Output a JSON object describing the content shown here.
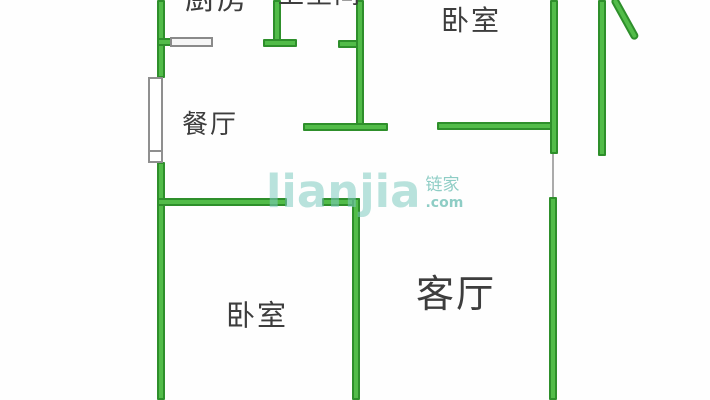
{
  "watermark": {
    "logo": "lianjia",
    "cjk": "链家",
    "tld": ".com"
  },
  "floorplan": {
    "colors": {
      "background": "#fefefe",
      "wall_fill": "#52bc49",
      "wall_edge": "#2e8f2b",
      "label_text": "#3d3d3d",
      "watermark_teal": "#7ecac0",
      "opening_gray": "#8f8f8f"
    },
    "rooms": [
      {
        "name": "room-label-kitchen",
        "label": "厨房",
        "cx": 217,
        "cy": 0,
        "font": 30
      },
      {
        "name": "room-label-bathroom",
        "label": "卫生间",
        "cx": 320,
        "cy": -5,
        "font": 26
      },
      {
        "name": "room-label-bedroom-top",
        "label": "卧室",
        "cx": 471,
        "cy": 21,
        "font": 28
      },
      {
        "name": "room-label-dining",
        "label": "餐厅",
        "cx": 210,
        "cy": 125,
        "font": 26
      },
      {
        "name": "room-label-bedroom-bottom",
        "label": "卧室",
        "cx": 257,
        "cy": 316,
        "font": 29
      },
      {
        "name": "room-label-living",
        "label": "客厅",
        "cx": 456,
        "cy": 294,
        "font": 38
      }
    ],
    "walls": [
      {
        "name": "left-wall-upper",
        "x": 157,
        "y": 0,
        "w": 8,
        "h": 78
      },
      {
        "name": "left-wall-lower",
        "x": 157,
        "y": 162,
        "w": 8,
        "h": 238
      },
      {
        "name": "kitchen-bottom-wall",
        "x": 157,
        "y": 38,
        "w": 20,
        "h": 8
      },
      {
        "name": "kitchen-bath-divider",
        "x": 273,
        "y": 0,
        "w": 8,
        "h": 47
      },
      {
        "name": "divider-endcap",
        "x": 263,
        "y": 39,
        "w": 34,
        "h": 8
      },
      {
        "name": "bath-entry-stub",
        "x": 338,
        "y": 40,
        "w": 26,
        "h": 8
      },
      {
        "name": "bath-bedroom-divider",
        "x": 356,
        "y": 0,
        "w": 8,
        "h": 131
      },
      {
        "name": "bath-bottom-wall",
        "x": 303,
        "y": 123,
        "w": 85,
        "h": 8
      },
      {
        "name": "bedroom-top-bottom-wall",
        "x": 437,
        "y": 122,
        "w": 118,
        "h": 8
      },
      {
        "name": "bedroom-top-right-wall",
        "x": 550,
        "y": 0,
        "w": 8,
        "h": 154
      },
      {
        "name": "outer-right-wall",
        "x": 598,
        "y": 0,
        "w": 8,
        "h": 156
      },
      {
        "name": "dining-bottom-wall",
        "x": 157,
        "y": 198,
        "w": 130,
        "h": 8
      },
      {
        "name": "bedroom-bottom-top-wall",
        "x": 322,
        "y": 198,
        "w": 38,
        "h": 8
      },
      {
        "name": "bedroom-living-divider",
        "x": 352,
        "y": 198,
        "w": 8,
        "h": 202
      },
      {
        "name": "living-right-wall",
        "x": 549,
        "y": 197,
        "w": 8,
        "h": 203
      }
    ],
    "diagonal_wall": {
      "name": "balcony-diagonal-wall",
      "x": 610,
      "y": 0,
      "w": 8,
      "len": 47,
      "angle": -29
    },
    "openings": [
      {
        "name": "left-window",
        "type": "window",
        "x": 148,
        "y": 77,
        "w": 15,
        "h": 86
      },
      {
        "name": "left-window-sill",
        "type": "sill",
        "x": 148,
        "y": 150,
        "w": 15,
        "h": 13
      },
      {
        "name": "kitchen-door",
        "type": "door",
        "x": 170,
        "y": 37,
        "w": 43,
        "h": 10
      },
      {
        "name": "doorway-gap-line",
        "type": "line",
        "x": 552,
        "y": 154,
        "w": 2,
        "h": 43
      }
    ]
  }
}
